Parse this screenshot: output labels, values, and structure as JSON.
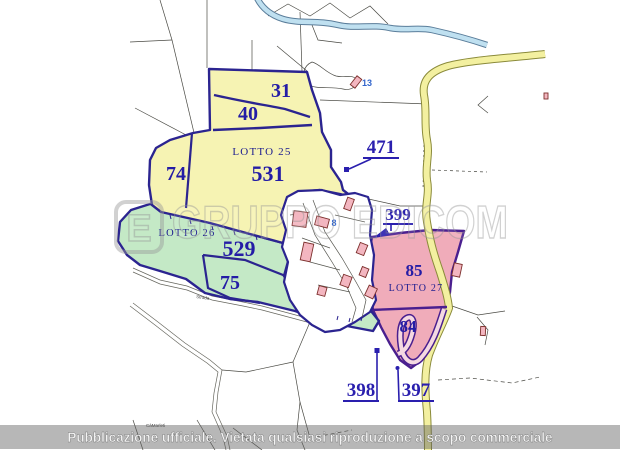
{
  "map": {
    "parcels": {
      "p31": "31",
      "p40": "40",
      "p74": "74",
      "p531": "531",
      "p529": "529",
      "p75": "75",
      "p85": "85",
      "p84": "84"
    },
    "lots": {
      "lotto25": "LOTTO 25",
      "lotto26": "LOTTO 26",
      "lotto27": "LOTTO 27"
    },
    "annotations": {
      "a471": "471",
      "a399": "399",
      "a398": "398",
      "a397": "397"
    },
    "minor_labels": {
      "b13": "13",
      "b8": "8",
      "strada": "Strada",
      "locality": "CàMarleti"
    }
  },
  "watermark": {
    "logo_letter": "E",
    "brand": "GRUPPO EDICOM"
  },
  "banner": {
    "text": "Pubblicazione ufficiale. Vietata qualsiasi riproduzione a scopo commerciale"
  },
  "colors": {
    "parcel_number": "#241ca6",
    "lot_label": "#1b1b8f",
    "lot_boundary": "#2b2490",
    "lot27_boundary": "#4a1f8f",
    "yellow_zone": "#f6f3b3",
    "green_zone": "#c4e9c6",
    "pink_zone": "#f0acba",
    "building_fill": "#f3b6c0",
    "building_stroke": "#7c2f2c",
    "river_fill": "#bfe0f0",
    "river_edge": "#5a7d9a",
    "road_fill": "#f3f0a0",
    "road_edge": "#8a8a3a"
  }
}
